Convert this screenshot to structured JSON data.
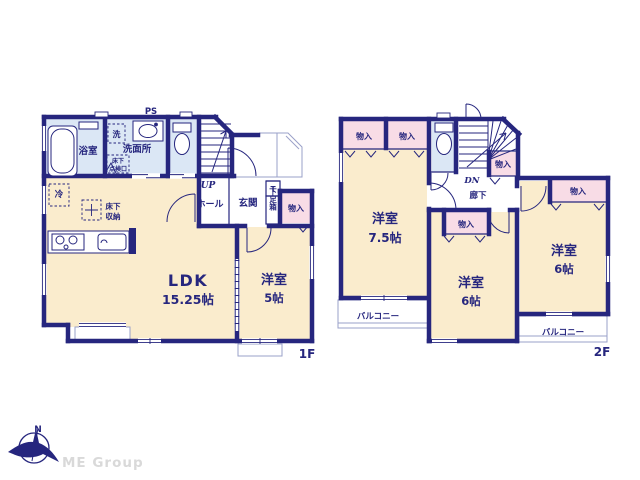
{
  "floor1": {
    "floor_label": "1F",
    "ldk": {
      "name": "LDK",
      "size": "15.25帖"
    },
    "western_room": {
      "name": "洋室",
      "size": "5帖"
    },
    "bathroom": "浴室",
    "washer": "洗",
    "washroom": "洗面所",
    "underfloor_hatch_line1": "床下",
    "underfloor_hatch_line2": "点検口",
    "ps": "PS",
    "up": "UP",
    "hall": "ホール",
    "entrance": "玄関",
    "shoe_box_t": "T",
    "shoe_box": "下足箱",
    "closet": "物入",
    "fridge": "冷",
    "underfloor_storage_line1": "床下",
    "underfloor_storage_line2": "収納"
  },
  "floor2": {
    "floor_label": "2F",
    "room_75": {
      "name": "洋室",
      "size": "7.5帖"
    },
    "room_6_center": {
      "name": "洋室",
      "size": "6帖"
    },
    "room_6_right": {
      "name": "洋室",
      "size": "6帖"
    },
    "closet": "物入",
    "corridor": "廊下",
    "dn": "DN",
    "balcony": "バルコニー"
  },
  "compass": {
    "north": "N"
  },
  "logo": {
    "text": "ME Group"
  },
  "colors": {
    "wall_navy": "#26267e",
    "room_cream": "#faeccd",
    "closet_pink": "#f8dce6",
    "wet_blue": "#dbe7f5",
    "thin_outline": "#9aa0c8",
    "logo_gray": "#d9d9d9"
  }
}
